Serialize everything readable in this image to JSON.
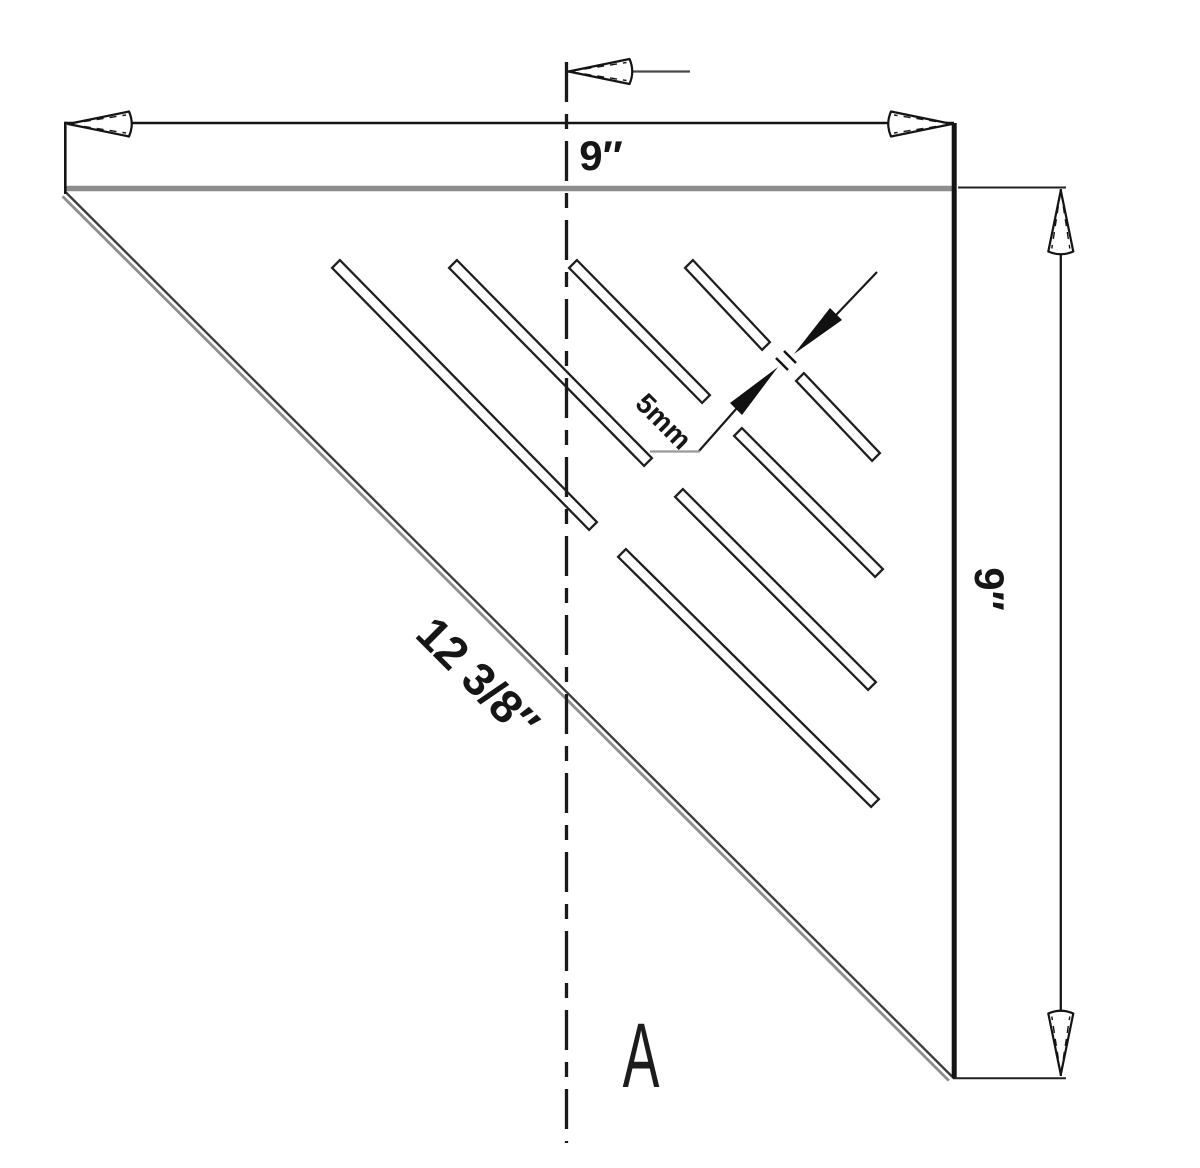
{
  "labels": {
    "top_width": "9″",
    "right_height": "9″",
    "hypotenuse_length": "12 3/8″",
    "slot_width": "5mm",
    "section_marker": "A"
  },
  "colors": {
    "line_black": "#161616",
    "edge_gray": "#8d8d8d",
    "hypotenuse_dark": "#3a3a3a",
    "background": "#ffffff"
  },
  "slots": {
    "count": 8,
    "orientation_deg": 45
  }
}
